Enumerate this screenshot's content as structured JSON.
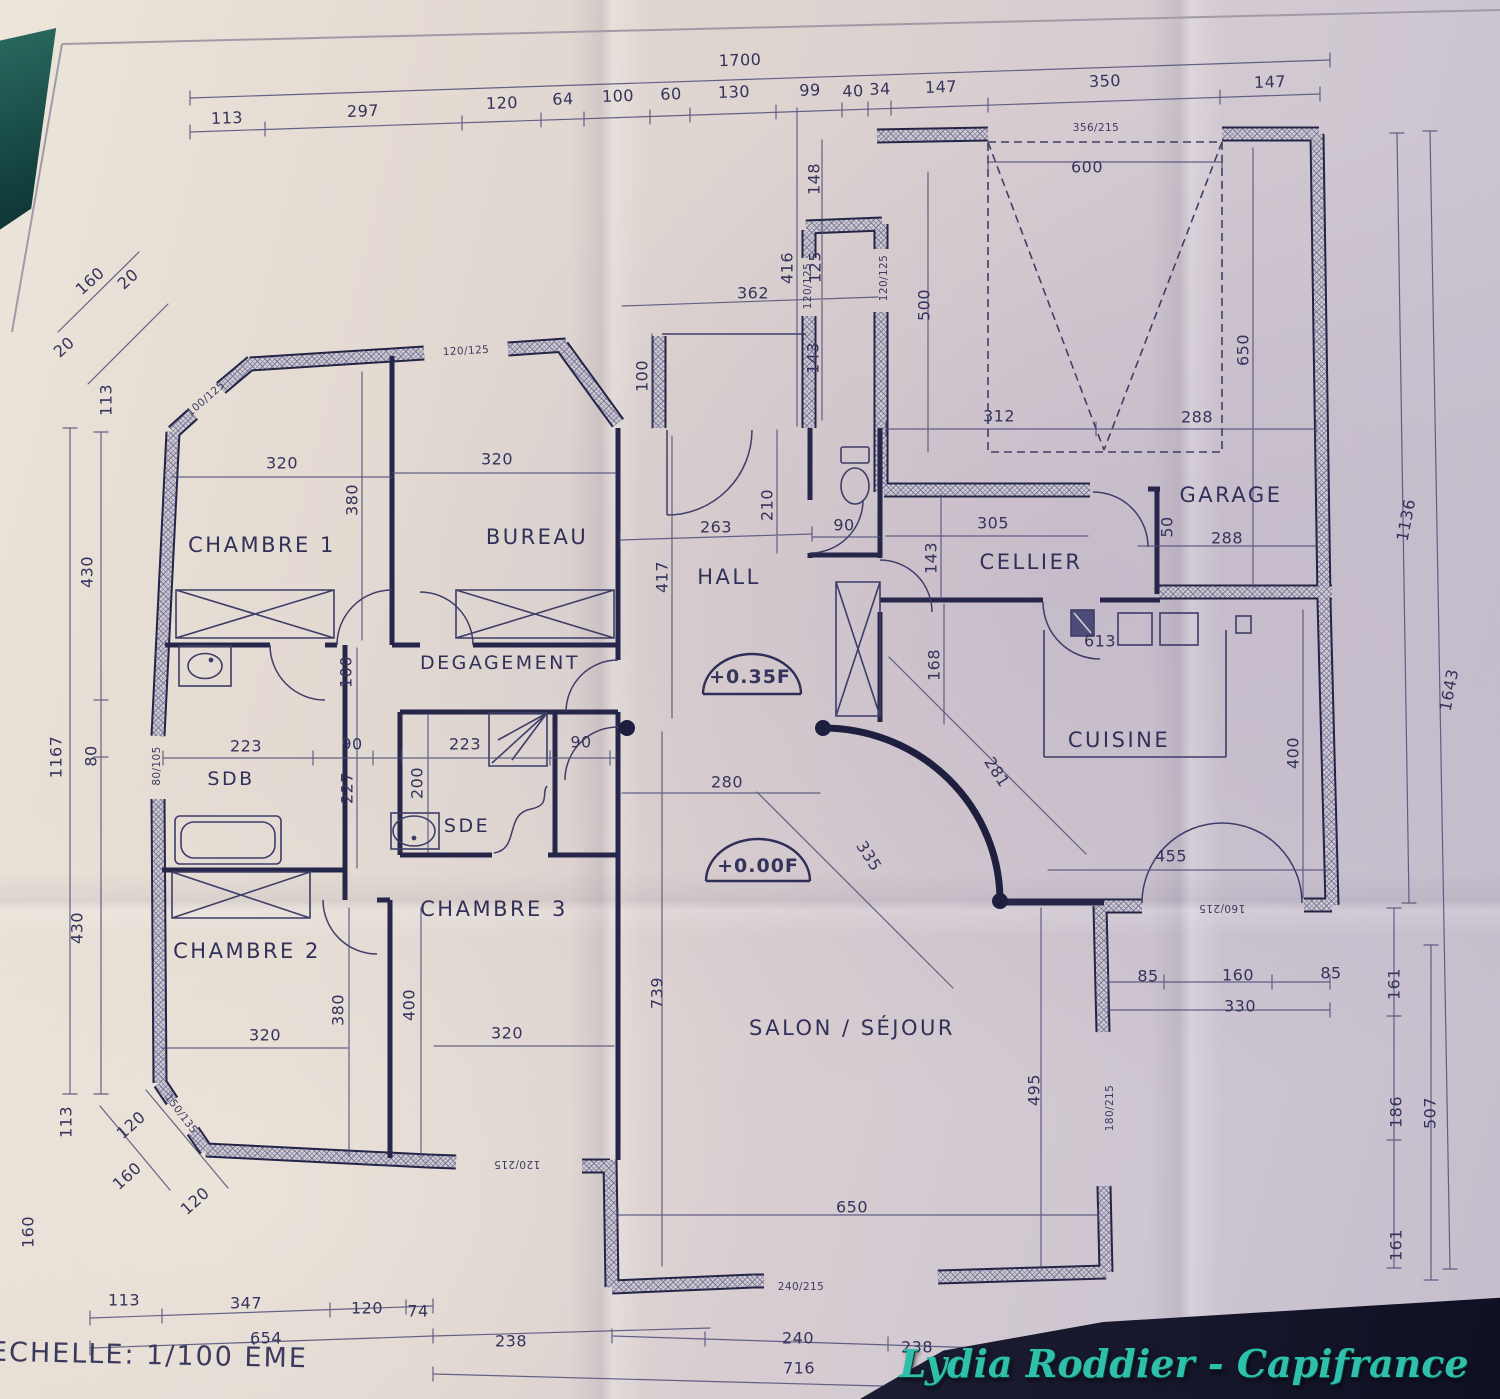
{
  "meta": {
    "type": "photographed floor plan"
  },
  "footer": {
    "scale": "ECHELLE: 1/100 ÈME"
  },
  "watermark": {
    "text": "Lydia Roddier - Capifrance",
    "color": "#2fc0ab"
  },
  "colors": {
    "ink": "#34345c",
    "wall": "#242447",
    "hatch": "#73739b",
    "paper": "#ddd3d0",
    "teal_corner": "#123f3c",
    "dark_corner": "#14142a"
  },
  "rooms": [
    {
      "label": "CHAMBRE 1",
      "x": 262,
      "y": 545
    },
    {
      "label": "BUREAU",
      "x": 537,
      "y": 537
    },
    {
      "label": "DEGAGEMENT",
      "x": 500,
      "y": 663,
      "s": 19
    },
    {
      "label": "HALL",
      "x": 729,
      "y": 577
    },
    {
      "label": "CELLIER",
      "x": 1031,
      "y": 562
    },
    {
      "label": "GARAGE",
      "x": 1231,
      "y": 495
    },
    {
      "label": "CUISINE",
      "x": 1119,
      "y": 740
    },
    {
      "label": "SDB",
      "x": 231,
      "y": 779,
      "s": 19
    },
    {
      "label": "SDE",
      "x": 467,
      "y": 826,
      "s": 19
    },
    {
      "label": "CHAMBRE 3",
      "x": 494,
      "y": 909
    },
    {
      "label": "CHAMBRE 2",
      "x": 247,
      "y": 951
    },
    {
      "label": "SALON / SÉJOUR",
      "x": 852,
      "y": 1028
    }
  ],
  "levels": [
    {
      "t": "+0.35F",
      "x": 750,
      "y": 677
    },
    {
      "t": "+0.00F",
      "x": 758,
      "y": 866
    }
  ],
  "dimensions": [
    {
      "t": "1700",
      "x": 740,
      "y": 60,
      "r": -2
    },
    {
      "t": "113",
      "x": 227,
      "y": 118,
      "r": -2
    },
    {
      "t": "297",
      "x": 363,
      "y": 111,
      "r": -2
    },
    {
      "t": "120",
      "x": 502,
      "y": 103,
      "r": -2
    },
    {
      "t": "64",
      "x": 563,
      "y": 99,
      "r": -2
    },
    {
      "t": "100",
      "x": 618,
      "y": 96,
      "r": -2
    },
    {
      "t": "60",
      "x": 671,
      "y": 94,
      "r": -2
    },
    {
      "t": "130",
      "x": 734,
      "y": 92,
      "r": -2
    },
    {
      "t": "99",
      "x": 810,
      "y": 90,
      "r": -2
    },
    {
      "t": "40",
      "x": 853,
      "y": 91,
      "r": -2
    },
    {
      "t": "34",
      "x": 880,
      "y": 89,
      "r": -2
    },
    {
      "t": "147",
      "x": 941,
      "y": 87,
      "r": -2
    },
    {
      "t": "350",
      "x": 1105,
      "y": 81,
      "r": -2
    },
    {
      "t": "147",
      "x": 1270,
      "y": 82,
      "r": -2
    },
    {
      "t": "160",
      "x": 90,
      "y": 281,
      "r": -42
    },
    {
      "t": "20",
      "x": 128,
      "y": 279,
      "r": -42
    },
    {
      "t": "20",
      "x": 64,
      "y": 347,
      "r": -42
    },
    {
      "t": "113",
      "x": 106,
      "y": 400,
      "r": -90
    },
    {
      "t": "430",
      "x": 87,
      "y": 572,
      "r": -90
    },
    {
      "t": "1167",
      "x": 56,
      "y": 757,
      "r": -90
    },
    {
      "t": "80",
      "x": 91,
      "y": 756,
      "r": -90
    },
    {
      "t": "430",
      "x": 77,
      "y": 928,
      "r": -90
    },
    {
      "t": "113",
      "x": 66,
      "y": 1122,
      "r": -90
    },
    {
      "t": "120",
      "x": 131,
      "y": 1125,
      "r": -42
    },
    {
      "t": "160",
      "x": 127,
      "y": 1176,
      "r": -42
    },
    {
      "t": "120",
      "x": 195,
      "y": 1201,
      "r": -42
    },
    {
      "t": "160",
      "x": 28,
      "y": 1232,
      "r": -90
    },
    {
      "t": "148",
      "x": 814,
      "y": 179,
      "r": -90
    },
    {
      "t": "416",
      "x": 787,
      "y": 268,
      "r": -90
    },
    {
      "t": "125",
      "x": 815,
      "y": 267,
      "r": -90
    },
    {
      "t": "362",
      "x": 753,
      "y": 293,
      "r": 0
    },
    {
      "t": "143",
      "x": 813,
      "y": 358,
      "r": -90
    },
    {
      "t": "100",
      "x": 642,
      "y": 376,
      "r": -90
    },
    {
      "t": "600",
      "x": 1087,
      "y": 167,
      "r": 0
    },
    {
      "t": "500",
      "x": 924,
      "y": 305,
      "r": -90
    },
    {
      "t": "650",
      "x": 1243,
      "y": 350,
      "r": -90
    },
    {
      "t": "312",
      "x": 999,
      "y": 416,
      "r": 0
    },
    {
      "t": "288",
      "x": 1197,
      "y": 417,
      "r": 0
    },
    {
      "t": "320",
      "x": 282,
      "y": 463,
      "r": 0
    },
    {
      "t": "320",
      "x": 497,
      "y": 459,
      "r": 0
    },
    {
      "t": "380",
      "x": 352,
      "y": 500,
      "r": -90
    },
    {
      "t": "263",
      "x": 716,
      "y": 527,
      "r": 0
    },
    {
      "t": "210",
      "x": 767,
      "y": 505,
      "r": -90
    },
    {
      "t": "90",
      "x": 844,
      "y": 525,
      "r": 0
    },
    {
      "t": "417",
      "x": 662,
      "y": 577,
      "r": -90
    },
    {
      "t": "305",
      "x": 993,
      "y": 523,
      "r": 0
    },
    {
      "t": "143",
      "x": 931,
      "y": 558,
      "r": -90
    },
    {
      "t": "50",
      "x": 1167,
      "y": 527,
      "r": -90
    },
    {
      "t": "288",
      "x": 1227,
      "y": 538,
      "r": 0
    },
    {
      "t": "168",
      "x": 934,
      "y": 665,
      "r": -90
    },
    {
      "t": "613",
      "x": 1100,
      "y": 641,
      "r": 0
    },
    {
      "t": "100",
      "x": 346,
      "y": 672,
      "r": -90
    },
    {
      "t": "223",
      "x": 246,
      "y": 746,
      "r": 0
    },
    {
      "t": "90",
      "x": 352,
      "y": 744,
      "r": 0
    },
    {
      "t": "227",
      "x": 347,
      "y": 788,
      "r": -90
    },
    {
      "t": "223",
      "x": 465,
      "y": 744,
      "r": 0
    },
    {
      "t": "90",
      "x": 581,
      "y": 742,
      "r": 0
    },
    {
      "t": "200",
      "x": 417,
      "y": 783,
      "r": -90
    },
    {
      "t": "400",
      "x": 1293,
      "y": 753,
      "r": -90
    },
    {
      "t": "455",
      "x": 1171,
      "y": 856,
      "r": 0
    },
    {
      "t": "281",
      "x": 997,
      "y": 772,
      "r": 57
    },
    {
      "t": "335",
      "x": 869,
      "y": 856,
      "r": 57
    },
    {
      "t": "280",
      "x": 727,
      "y": 782,
      "r": 0
    },
    {
      "t": "739",
      "x": 657,
      "y": 993,
      "r": -90
    },
    {
      "t": "495",
      "x": 1034,
      "y": 1090,
      "r": -90
    },
    {
      "t": "650",
      "x": 852,
      "y": 1207,
      "r": 0
    },
    {
      "t": "320",
      "x": 265,
      "y": 1035,
      "r": 0
    },
    {
      "t": "380",
      "x": 338,
      "y": 1010,
      "r": -90
    },
    {
      "t": "400",
      "x": 409,
      "y": 1005,
      "r": -90
    },
    {
      "t": "320",
      "x": 507,
      "y": 1033,
      "r": 0
    },
    {
      "t": "1136",
      "x": 1406,
      "y": 520,
      "r": -79
    },
    {
      "t": "1643",
      "x": 1449,
      "y": 690,
      "r": -79
    },
    {
      "t": "85",
      "x": 1148,
      "y": 976,
      "r": 0
    },
    {
      "t": "160",
      "x": 1238,
      "y": 975,
      "r": 0
    },
    {
      "t": "85",
      "x": 1331,
      "y": 973,
      "r": 0
    },
    {
      "t": "330",
      "x": 1240,
      "y": 1006,
      "r": 0
    },
    {
      "t": "161",
      "x": 1394,
      "y": 984,
      "r": -90
    },
    {
      "t": "186",
      "x": 1396,
      "y": 1112,
      "r": -90
    },
    {
      "t": "507",
      "x": 1430,
      "y": 1113,
      "r": -90
    },
    {
      "t": "161",
      "x": 1396,
      "y": 1245,
      "r": -90
    },
    {
      "t": "113",
      "x": 124,
      "y": 1300,
      "r": 0
    },
    {
      "t": "347",
      "x": 246,
      "y": 1303,
      "r": 0
    },
    {
      "t": "120",
      "x": 367,
      "y": 1308,
      "r": 0
    },
    {
      "t": "74",
      "x": 418,
      "y": 1311,
      "r": 0
    },
    {
      "t": "654",
      "x": 266,
      "y": 1338,
      "r": 0
    },
    {
      "t": "238",
      "x": 511,
      "y": 1341,
      "r": 0
    },
    {
      "t": "240",
      "x": 798,
      "y": 1338,
      "r": 0
    },
    {
      "t": "238",
      "x": 917,
      "y": 1347,
      "r": 0
    },
    {
      "t": "716",
      "x": 799,
      "y": 1368,
      "r": 0
    }
  ],
  "wall_labels": [
    {
      "t": "100/125",
      "x": 206,
      "y": 399,
      "r": -41
    },
    {
      "t": "120/125",
      "x": 466,
      "y": 351,
      "r": -3
    },
    {
      "t": "120/125",
      "x": 808,
      "y": 286,
      "r": -90
    },
    {
      "t": "120/125",
      "x": 884,
      "y": 278,
      "r": -90
    },
    {
      "t": "356/215",
      "x": 1096,
      "y": 128,
      "r": 0
    },
    {
      "t": "80/105",
      "x": 157,
      "y": 766,
      "r": -90
    },
    {
      "t": "150/135",
      "x": 181,
      "y": 1114,
      "r": 53
    },
    {
      "t": "120/215",
      "x": 517,
      "y": 1164,
      "r": 180
    },
    {
      "t": "240/215",
      "x": 801,
      "y": 1287,
      "r": 0
    },
    {
      "t": "160/215",
      "x": 1222,
      "y": 908,
      "r": 180
    },
    {
      "t": "180/215",
      "x": 1110,
      "y": 1108,
      "r": -90
    }
  ]
}
